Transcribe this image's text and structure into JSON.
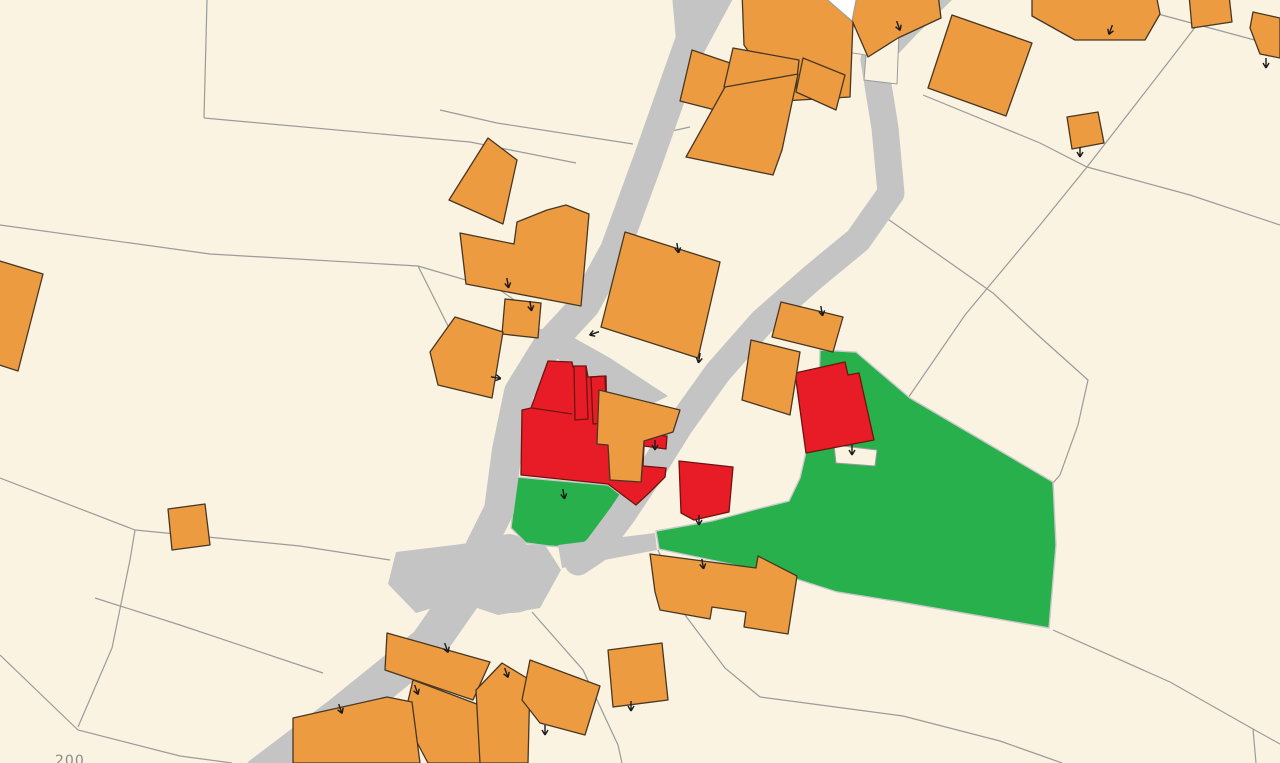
{
  "map": {
    "parcel_label": "200",
    "colors": {
      "background": "#faf3e1",
      "parcel_line": "#9b9b9b",
      "road": "#c4c4c4",
      "building_orange": "#ec9b41",
      "building_orange_edge": "#473723",
      "building_red": "#e81c26",
      "building_red_edge": "#6d1410",
      "parcel_green": "#27b04b",
      "parcel_green_edge": "#c9c9c9",
      "building_white": "#ffffff",
      "tick": "#1a1a1a",
      "label": "#8a8a8a"
    },
    "parcel_lines": [
      [
        [
          207,
          0
        ],
        [
          204,
          118
        ]
      ],
      [
        [
          204,
          118
        ],
        [
          470,
          142
        ],
        [
          576,
          163
        ]
      ],
      [
        [
          0,
          225
        ],
        [
          210,
          254
        ],
        [
          418,
          266
        ],
        [
          450,
          330
        ]
      ],
      [
        [
          418,
          266
        ],
        [
          500,
          290
        ],
        [
          540,
          318
        ]
      ],
      [
        [
          440,
          110
        ],
        [
          497,
          123
        ],
        [
          633,
          144
        ]
      ],
      [
        [
          658,
          134
        ],
        [
          690,
          127
        ]
      ],
      [
        [
          1216,
          0
        ],
        [
          1170,
          60
        ],
        [
          1087,
          167
        ],
        [
          1040,
          225
        ],
        [
          965,
          315
        ],
        [
          908,
          398
        ]
      ],
      [
        [
          923,
          95
        ],
        [
          1040,
          143
        ],
        [
          1087,
          167
        ],
        [
          1190,
          195
        ],
        [
          1280,
          225
        ]
      ],
      [
        [
          875,
          210
        ],
        [
          993,
          293
        ],
        [
          1040,
          337
        ],
        [
          1088,
          380
        ],
        [
          1078,
          425
        ],
        [
          1060,
          475
        ],
        [
          1053,
          483
        ]
      ],
      [
        [
          1053,
          630
        ],
        [
          1170,
          682
        ],
        [
          1253,
          729
        ],
        [
          1280,
          744
        ]
      ],
      [
        [
          1253,
          729
        ],
        [
          1256,
          763
        ]
      ],
      [
        [
          760,
          697
        ],
        [
          903,
          716
        ],
        [
          1000,
          741
        ],
        [
          1062,
          763
        ]
      ],
      [
        [
          658,
          550
        ],
        [
          685,
          615
        ],
        [
          725,
          668
        ],
        [
          760,
          697
        ]
      ],
      [
        [
          95,
          598
        ],
        [
          180,
          625
        ],
        [
          323,
          673
        ]
      ],
      [
        [
          0,
          655
        ],
        [
          78,
          730
        ],
        [
          180,
          756
        ],
        [
          232,
          763
        ]
      ],
      [
        [
          0,
          478
        ],
        [
          135,
          530
        ],
        [
          300,
          546
        ],
        [
          390,
          560
        ]
      ],
      [
        [
          532,
          612
        ],
        [
          583,
          670
        ],
        [
          618,
          745
        ],
        [
          622,
          763
        ]
      ],
      [
        [
          78,
          727
        ],
        [
          112,
          648
        ],
        [
          130,
          560
        ],
        [
          135,
          530
        ]
      ],
      [
        [
          1158,
          14
        ],
        [
          1262,
          42
        ],
        [
          1280,
          47
        ]
      ]
    ],
    "green_parcels": [
      [
        [
          517,
          477
        ],
        [
          608,
          485
        ],
        [
          636,
          507
        ],
        [
          610,
          550
        ],
        [
          548,
          546
        ],
        [
          526,
          543
        ],
        [
          511,
          528
        ]
      ],
      [
        [
          820,
          350
        ],
        [
          856,
          352
        ],
        [
          910,
          398
        ],
        [
          1053,
          482
        ],
        [
          1056,
          545
        ],
        [
          1049,
          628
        ],
        [
          900,
          602
        ],
        [
          837,
          592
        ],
        [
          790,
          577
        ],
        [
          730,
          564
        ],
        [
          659,
          549
        ],
        [
          656,
          531
        ],
        [
          712,
          521
        ],
        [
          757,
          509
        ],
        [
          789,
          501
        ],
        [
          800,
          478
        ],
        [
          806,
          452
        ],
        [
          818,
          430
        ]
      ]
    ],
    "road_paths": [
      {
        "d": "M 701,10 L 678,75 L 648,160 L 615,250 L 585,305 L 548,345 L 519,392 L 507,450 L 499,510 L 480,548",
        "w": 30
      },
      {
        "d": "M 509,553 L 470,585 L 428,645 L 340,716 L 262,775",
        "w": 38
      },
      {
        "d": "M 948,-15 L 906,26 L 874,60 L 885,128 L 891,193 L 858,240 L 812,278 L 762,322 L 718,372 L 680,425 L 652,470 L 622,515 L 596,550 L 578,562",
        "w": 27
      }
    ],
    "road_polys": [
      [
        [
          672,
          -5
        ],
        [
          735,
          -5
        ],
        [
          700,
          60
        ],
        [
          676,
          40
        ]
      ],
      [
        [
          524,
          328
        ],
        [
          560,
          330
        ],
        [
          610,
          358
        ],
        [
          668,
          396
        ],
        [
          640,
          410
        ],
        [
          600,
          389
        ],
        [
          548,
          352
        ]
      ],
      [
        [
          396,
          552
        ],
        [
          470,
          543
        ],
        [
          545,
          545
        ],
        [
          561,
          570
        ],
        [
          540,
          608
        ],
        [
          498,
          615
        ],
        [
          456,
          601
        ],
        [
          416,
          613
        ],
        [
          388,
          584
        ]
      ],
      [
        [
          558,
          545
        ],
        [
          655,
          533
        ],
        [
          657,
          550
        ],
        [
          562,
          568
        ]
      ]
    ],
    "road_bulb": {
      "cx": 513,
      "cy": 592,
      "rx": 27,
      "ry": 21
    },
    "cream_patches": [
      [
        [
          834,
          445
        ],
        [
          877,
          450
        ],
        [
          875,
          466
        ],
        [
          836,
          463
        ]
      ],
      [
        [
          845,
          26
        ],
        [
          899,
          32
        ],
        [
          897,
          84
        ],
        [
          864,
          80
        ],
        [
          866,
          55
        ],
        [
          846,
          52
        ]
      ]
    ],
    "red_buildings": [
      [
        [
          548,
          361
        ],
        [
          572,
          362
        ],
        [
          573,
          367
        ],
        [
          586,
          366
        ],
        [
          588,
          377
        ],
        [
          606,
          376
        ],
        [
          607,
          430
        ],
        [
          667,
          436
        ],
        [
          666,
          449
        ],
        [
          644,
          446
        ],
        [
          643,
          466
        ],
        [
          666,
          468
        ],
        [
          665,
          477
        ],
        [
          650,
          492
        ],
        [
          636,
          505
        ],
        [
          608,
          484
        ],
        [
          521,
          475
        ],
        [
          522,
          410
        ],
        [
          531,
          408
        ]
      ],
      [
        [
          574,
          366
        ],
        [
          586,
          366
        ],
        [
          588,
          419
        ],
        [
          575,
          420
        ]
      ],
      [
        [
          591,
          377
        ],
        [
          605,
          376
        ],
        [
          607,
          423
        ],
        [
          593,
          424
        ]
      ],
      [
        [
          679,
          461
        ],
        [
          733,
          467
        ],
        [
          729,
          512
        ],
        [
          694,
          520
        ],
        [
          681,
          513
        ]
      ],
      [
        [
          795,
          373
        ],
        [
          845,
          362
        ],
        [
          848,
          375
        ],
        [
          859,
          373
        ],
        [
          874,
          440
        ],
        [
          806,
          453
        ]
      ]
    ],
    "red_inner_lines": [
      [
        [
          532,
          408
        ],
        [
          572,
          414
        ]
      ]
    ],
    "orange_buildings": [
      [
        [
          742,
          -8
        ],
        [
          822,
          -8
        ],
        [
          853,
          22
        ],
        [
          850,
          97
        ],
        [
          783,
          101
        ],
        [
          744,
          45
        ]
      ],
      [
        [
          853,
          -6
        ],
        [
          938,
          -6
        ],
        [
          941,
          18
        ],
        [
          898,
          38
        ],
        [
          868,
          57
        ],
        [
          851,
          18
        ]
      ],
      [
        [
          952,
          15
        ],
        [
          1032,
          43
        ],
        [
          1006,
          116
        ],
        [
          928,
          88
        ]
      ],
      [
        [
          1032,
          -6
        ],
        [
          1156,
          -6
        ],
        [
          1160,
          14
        ],
        [
          1145,
          40
        ],
        [
          1075,
          40
        ],
        [
          1032,
          16
        ]
      ],
      [
        [
          1189,
          -5
        ],
        [
          1229,
          -5
        ],
        [
          1232,
          22
        ],
        [
          1192,
          28
        ]
      ],
      [
        [
          1253,
          12
        ],
        [
          1280,
          18
        ],
        [
          1280,
          58
        ],
        [
          1260,
          54
        ],
        [
          1250,
          28
        ]
      ],
      [
        [
          1067,
          117
        ],
        [
          1098,
          112
        ],
        [
          1104,
          143
        ],
        [
          1072,
          149
        ]
      ],
      [
        [
          692,
          50
        ],
        [
          733,
          64
        ],
        [
          723,
          112
        ],
        [
          680,
          101
        ]
      ],
      [
        [
          733,
          48
        ],
        [
          799,
          60
        ],
        [
          796,
          88
        ],
        [
          724,
          87
        ]
      ],
      [
        [
          803,
          58
        ],
        [
          845,
          75
        ],
        [
          836,
          110
        ],
        [
          796,
          92
        ]
      ],
      [
        [
          725,
          87
        ],
        [
          798,
          74
        ],
        [
          782,
          150
        ],
        [
          773,
          175
        ],
        [
          686,
          157
        ]
      ],
      [
        [
          488,
          138
        ],
        [
          517,
          160
        ],
        [
          503,
          224
        ],
        [
          449,
          200
        ]
      ],
      [
        [
          460,
          233
        ],
        [
          514,
          244
        ],
        [
          517,
          222
        ],
        [
          547,
          210
        ],
        [
          566,
          205
        ],
        [
          589,
          214
        ],
        [
          581,
          306
        ],
        [
          466,
          284
        ]
      ],
      [
        [
          505,
          299
        ],
        [
          541,
          303
        ],
        [
          538,
          338
        ],
        [
          502,
          334
        ]
      ],
      [
        [
          455,
          317
        ],
        [
          503,
          332
        ],
        [
          492,
          398
        ],
        [
          438,
          385
        ],
        [
          430,
          352
        ]
      ],
      [
        [
          599,
          390
        ],
        [
          680,
          410
        ],
        [
          673,
          432
        ],
        [
          644,
          441
        ],
        [
          641,
          482
        ],
        [
          610,
          480
        ],
        [
          608,
          445
        ],
        [
          597,
          444
        ]
      ],
      [
        [
          625,
          232
        ],
        [
          720,
          262
        ],
        [
          698,
          358
        ],
        [
          601,
          327
        ]
      ],
      [
        [
          781,
          302
        ],
        [
          843,
          317
        ],
        [
          833,
          352
        ],
        [
          772,
          337
        ]
      ],
      [
        [
          751,
          340
        ],
        [
          800,
          352
        ],
        [
          790,
          415
        ],
        [
          742,
          400
        ]
      ],
      [
        [
          608,
          650
        ],
        [
          662,
          643
        ],
        [
          668,
          700
        ],
        [
          613,
          707
        ]
      ],
      [
        [
          650,
          554
        ],
        [
          756,
          568
        ],
        [
          758,
          556
        ],
        [
          797,
          576
        ],
        [
          788,
          634
        ],
        [
          744,
          627
        ],
        [
          746,
          612
        ],
        [
          712,
          607
        ],
        [
          710,
          619
        ],
        [
          660,
          610
        ],
        [
          655,
          592
        ]
      ],
      [
        [
          387,
          633
        ],
        [
          490,
          662
        ],
        [
          473,
          700
        ],
        [
          385,
          670
        ]
      ],
      [
        [
          413,
          680
        ],
        [
          482,
          706
        ],
        [
          493,
          763
        ],
        [
          428,
          763
        ],
        [
          404,
          718
        ]
      ],
      [
        [
          502,
          663
        ],
        [
          530,
          680
        ],
        [
          528,
          763
        ],
        [
          480,
          763
        ],
        [
          476,
          690
        ]
      ],
      [
        [
          530,
          660
        ],
        [
          600,
          686
        ],
        [
          585,
          735
        ],
        [
          540,
          723
        ],
        [
          522,
          700
        ]
      ],
      [
        [
          293,
          718
        ],
        [
          387,
          697
        ],
        [
          412,
          702
        ],
        [
          420,
          763
        ],
        [
          293,
          763
        ]
      ],
      [
        [
          168,
          509
        ],
        [
          205,
          504
        ],
        [
          210,
          545
        ],
        [
          172,
          550
        ]
      ],
      [
        [
          -10,
          258
        ],
        [
          43,
          274
        ],
        [
          18,
          371
        ],
        [
          -10,
          362
        ]
      ]
    ],
    "white_buildings": [
      [
        [
          822,
          -5
        ],
        [
          857,
          -5
        ],
        [
          852,
          21
        ]
      ]
    ],
    "ticks": [
      {
        "x": 897,
        "y": 22,
        "r": 160
      },
      {
        "x": 1112,
        "y": 26,
        "r": 200
      },
      {
        "x": 1080,
        "y": 148,
        "r": 180
      },
      {
        "x": 677,
        "y": 244,
        "r": 170
      },
      {
        "x": 700,
        "y": 354,
        "r": 190
      },
      {
        "x": 821,
        "y": 307,
        "r": 170
      },
      {
        "x": 507,
        "y": 279,
        "r": 170
      },
      {
        "x": 530,
        "y": 302,
        "r": 170
      },
      {
        "x": 598,
        "y": 332,
        "r": 250
      },
      {
        "x": 492,
        "y": 377,
        "r": 100
      },
      {
        "x": 655,
        "y": 441,
        "r": 180
      },
      {
        "x": 563,
        "y": 490,
        "r": 170
      },
      {
        "x": 699,
        "y": 516,
        "r": 180
      },
      {
        "x": 852,
        "y": 446,
        "r": 180
      },
      {
        "x": 702,
        "y": 560,
        "r": 170
      },
      {
        "x": 631,
        "y": 702,
        "r": 180
      },
      {
        "x": 445,
        "y": 644,
        "r": 160
      },
      {
        "x": 415,
        "y": 686,
        "r": 160
      },
      {
        "x": 505,
        "y": 669,
        "r": 160
      },
      {
        "x": 545,
        "y": 726,
        "r": 180
      },
      {
        "x": 339,
        "y": 705,
        "r": 160
      },
      {
        "x": 1266,
        "y": 59,
        "r": 180
      }
    ],
    "label_pos": {
      "x": 55,
      "y": 765,
      "size": 14
    }
  }
}
